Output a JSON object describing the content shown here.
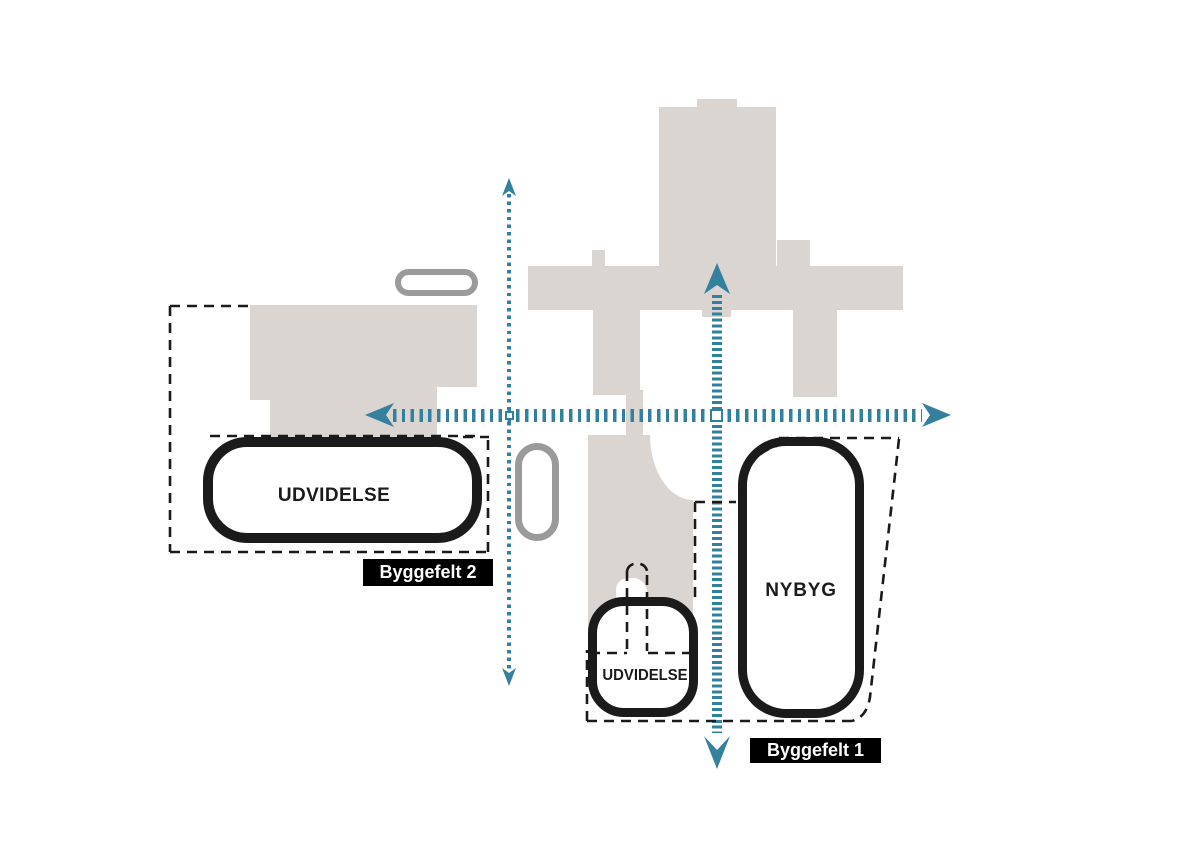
{
  "plan": {
    "buildings": {
      "expansion_2_label": "UDVIDELSE",
      "expansion_1_label": "UDVIDELSE",
      "newbuild_label": "NYBYG"
    },
    "tags": {
      "byggefelt_2": "Byggefelt 2",
      "byggefelt_1": "Byggefelt 1"
    },
    "colors": {
      "beige": "#dad5d0",
      "teal": "#32809f",
      "teal_dark": "#35809c",
      "gray": "#9a9a9a",
      "black": "#1b1b1b",
      "dash": "#1a1a1a"
    }
  }
}
